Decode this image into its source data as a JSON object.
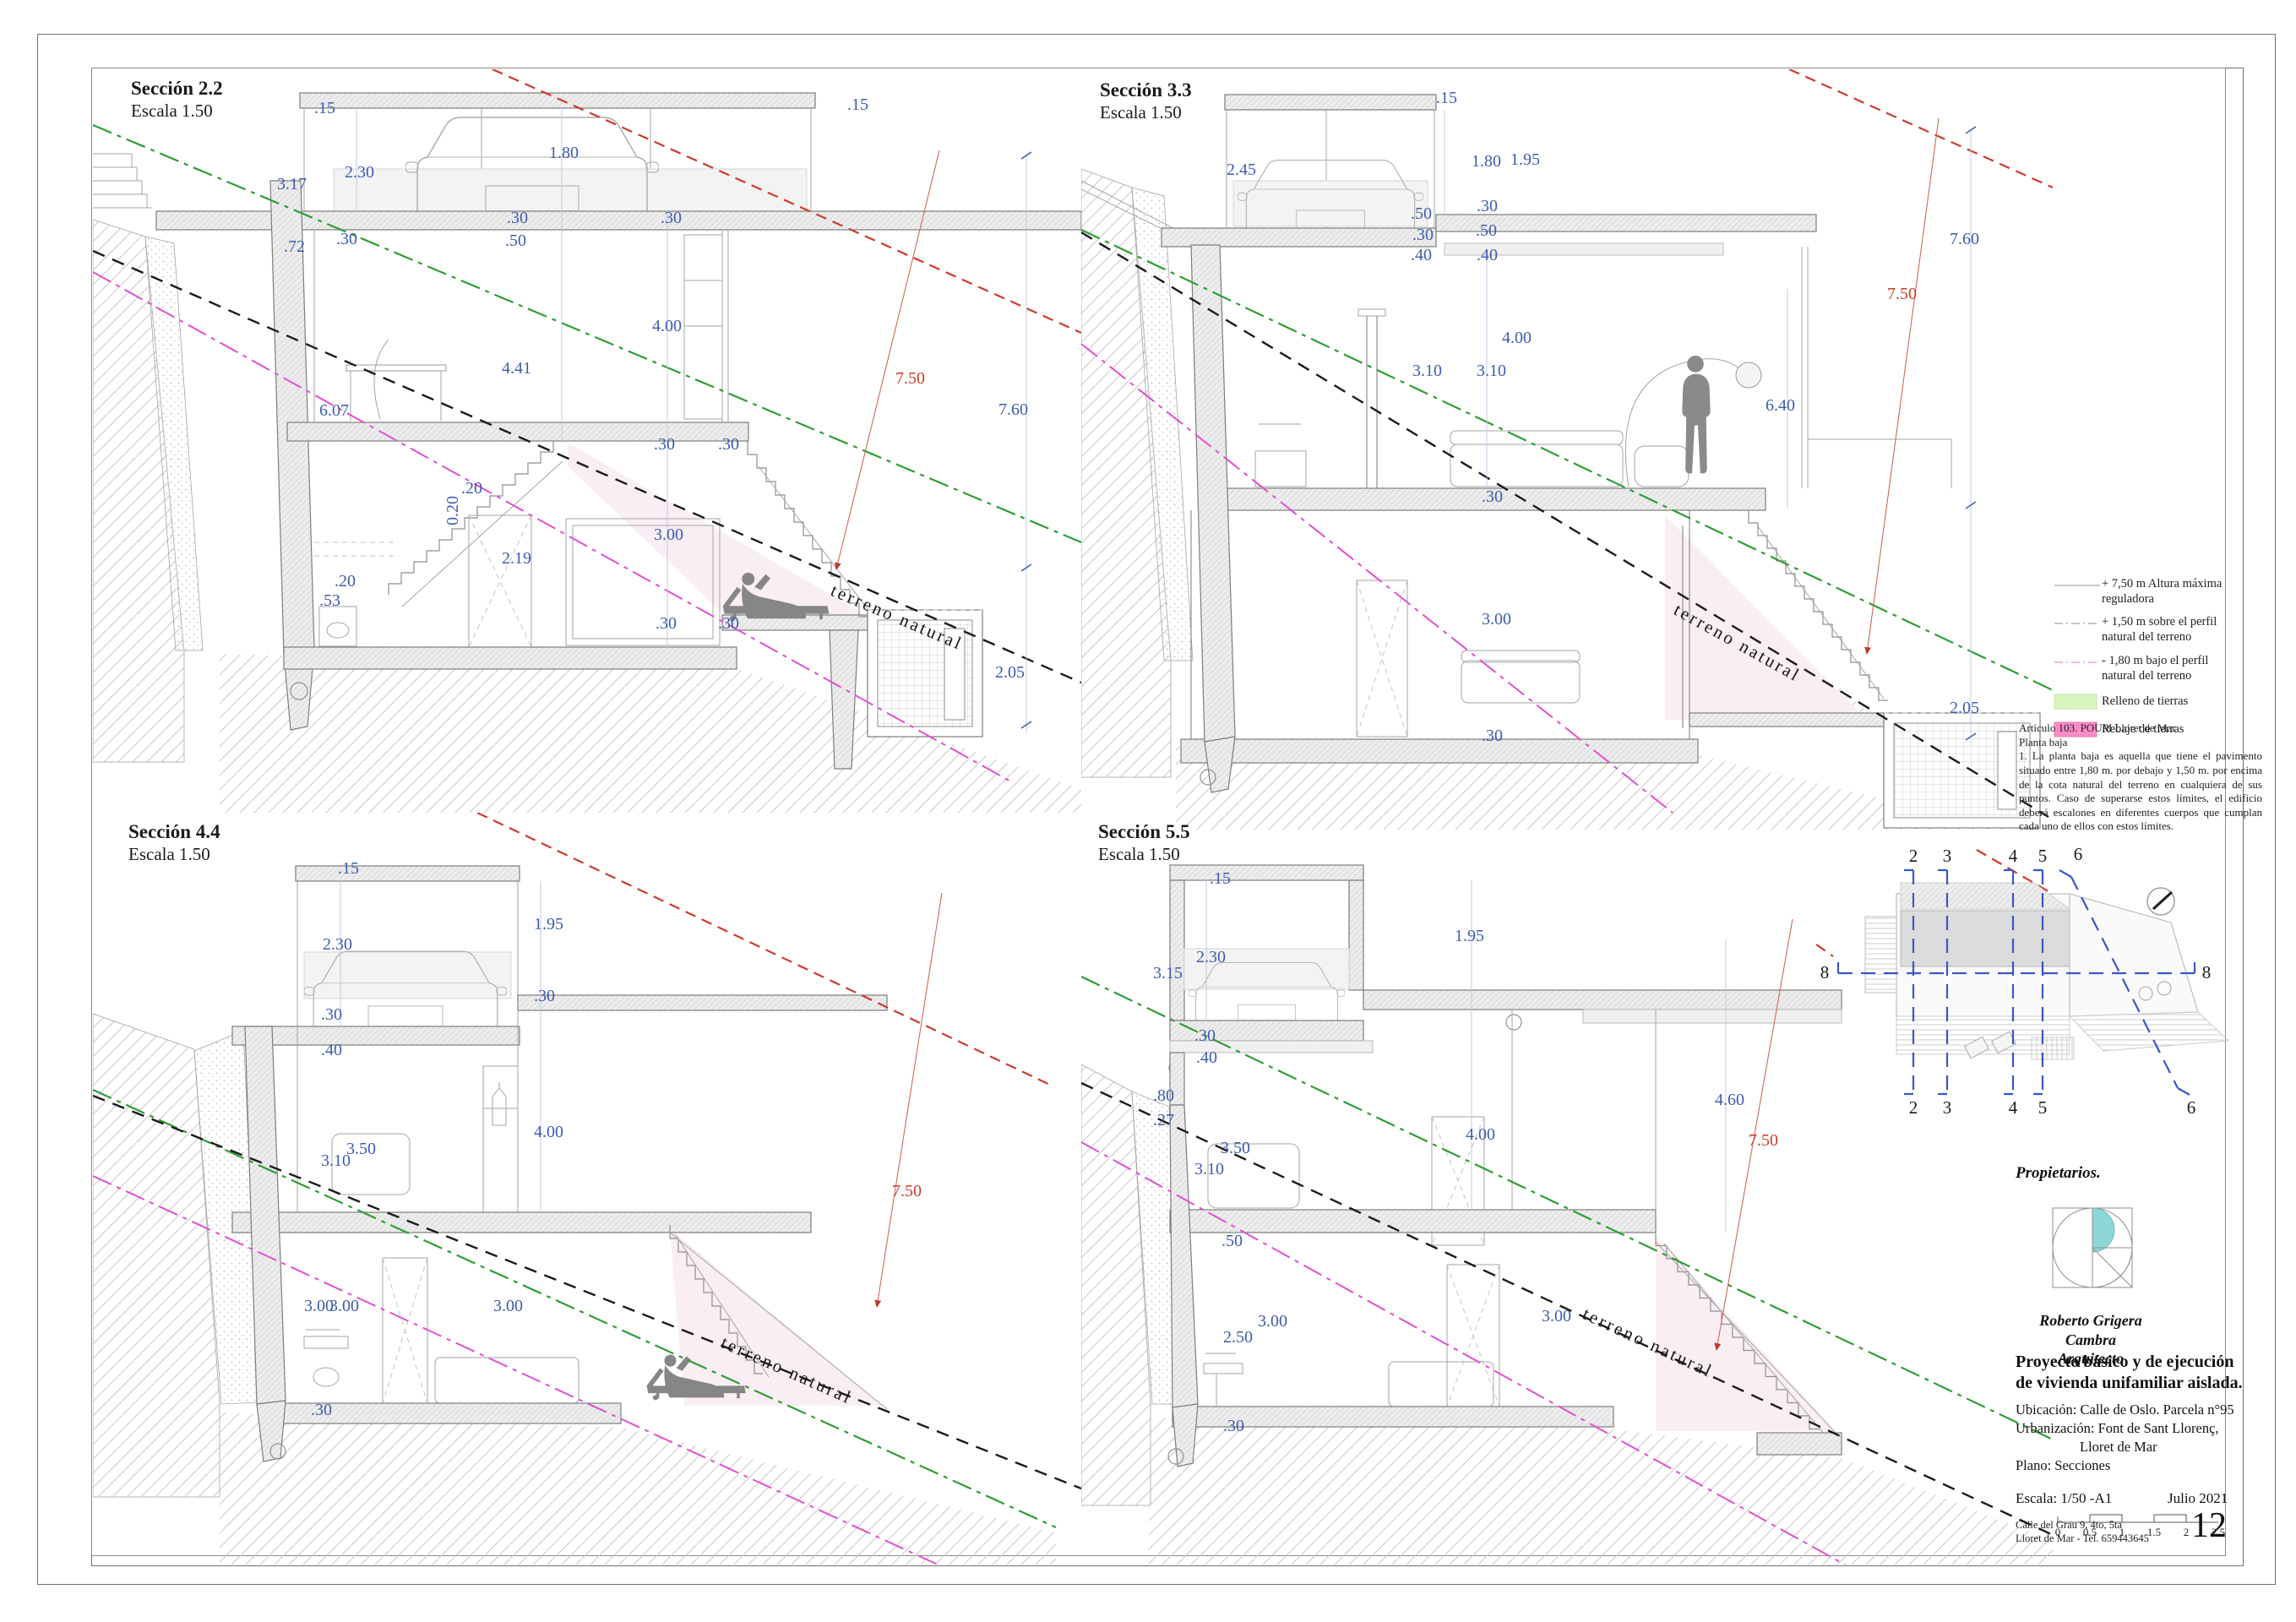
{
  "sections": [
    {
      "title": "Sección 2.2",
      "scale": "Escala 1.50",
      "terrain_label": "terreno natural",
      "dims": [
        ".15",
        ".15",
        "2.30",
        "1.80",
        "3.17",
        ".30",
        ".72",
        ".30",
        ".50",
        ".30",
        "4.00",
        "4.41",
        "6.07",
        ".30",
        ".20",
        "0.20",
        ".20",
        "2.19",
        "3.00",
        ".53",
        ".30",
        ".30",
        ".30",
        "7.50",
        "7.60",
        "2.05"
      ]
    },
    {
      "title": "Sección 3.3",
      "scale": "Escala 1.50",
      "terrain_label": "terreno natural",
      "dims": [
        ".15",
        "2.45",
        "1.80",
        "1.95",
        ".50",
        ".30",
        ".40",
        ".30",
        ".50",
        ".40",
        "3.10",
        "3.10",
        "4.00",
        "6.40",
        ".30",
        "3.00",
        ".30",
        "7.50",
        "7.60",
        "2.05"
      ]
    },
    {
      "title": "Sección 4.4",
      "scale": "Escala 1.50",
      "terrain_label": "terreno natural",
      "dims": [
        ".15",
        "2.30",
        "1.95",
        ".30",
        ".40",
        ".30",
        "3.10",
        "3.50",
        "4.00",
        "3.00",
        "3.00",
        "3.00",
        ".30",
        "7.50"
      ]
    },
    {
      "title": "Sección 5.5",
      "scale": "Escala 1.50",
      "terrain_label": "terreno natural",
      "dims": [
        ".15",
        "2.30",
        "3.15",
        "1.95",
        ".30",
        ".40",
        ".80",
        ".27",
        "3.10",
        "3.50",
        "4.00",
        "4.60",
        "7.50",
        ".50",
        "3.00",
        "2.50",
        "3.00",
        ".30"
      ]
    }
  ],
  "legend": {
    "items": [
      {
        "label": "+ 7,50 m Altura máxima reguladora",
        "color": "#b9b9b9",
        "style": "solid-line"
      },
      {
        "label": "+ 1,50 m sobre el perfil natural del terreno",
        "color": "#a4bda4",
        "style": "dash-dot-line"
      },
      {
        "label": "- 1,80 m bajo el perfil natural del terreno",
        "color": "#eda4d6",
        "style": "dash-dot-line"
      },
      {
        "label": "Relleno de tierras",
        "color": "#d9f6be",
        "style": "fill"
      },
      {
        "label": "Rebaje de tierras",
        "color": "#f98cc6",
        "style": "fill"
      }
    ]
  },
  "regulation_note": {
    "line1": "Artículo 103. POUM Lloret de Mar",
    "line2": "Planta baja",
    "body": "1. La planta baja es aquella que tiene el pavimento situado entre 1,80 m. por debajo y 1,50 m. por encima de la cota natural del terreno en cualquiera de sus puntos. Caso de superarse estos límites, el edificio deberá escalones en diferentes cuerpos que cumplan cada uno de ellos con estos límites."
  },
  "keyplan": {
    "labels": {
      "top": [
        "2",
        "3",
        "4",
        "5",
        "6"
      ],
      "bottom": [
        "2",
        "3",
        "4",
        "5",
        "6"
      ],
      "left": "8",
      "right": "8"
    }
  },
  "titleblock": {
    "owners_label": "Propietarios.",
    "architect_name": "Roberto Grigera Cambra",
    "architect_title": "Arquitecto",
    "project_title": "Proyecto básico y de ejecución de vivienda unifamiliar aislada.",
    "location": "Ubicación: Calle de Oslo. Parcela n°95",
    "urbanization": "Urbanización: Font de Sant Llorenç,",
    "city": "Lloret de Mar",
    "plan": "Plano: Secciones",
    "scale_label": "Escala:  1/50 -A1",
    "date": "Julio 2021",
    "address_line1": "Calle del Grau 9, 4to, 5ta",
    "address_line2": "Lloret de Mar - Tel. 659443645",
    "page_number": "12",
    "scalebar_ticks": [
      "0",
      "0.5",
      "1",
      "1.5",
      "2",
      "2.5"
    ]
  },
  "colors": {
    "dimension_blue": "#3c5cae",
    "regulation_red": "#cc3b2a",
    "profile_green": "#2f9e33",
    "below_profile_magenta": "#e14fd2",
    "terrain_black": "#1b1b1b",
    "section_line_blue": "#3a56c8",
    "logo_teal": "#8ed7d8"
  }
}
